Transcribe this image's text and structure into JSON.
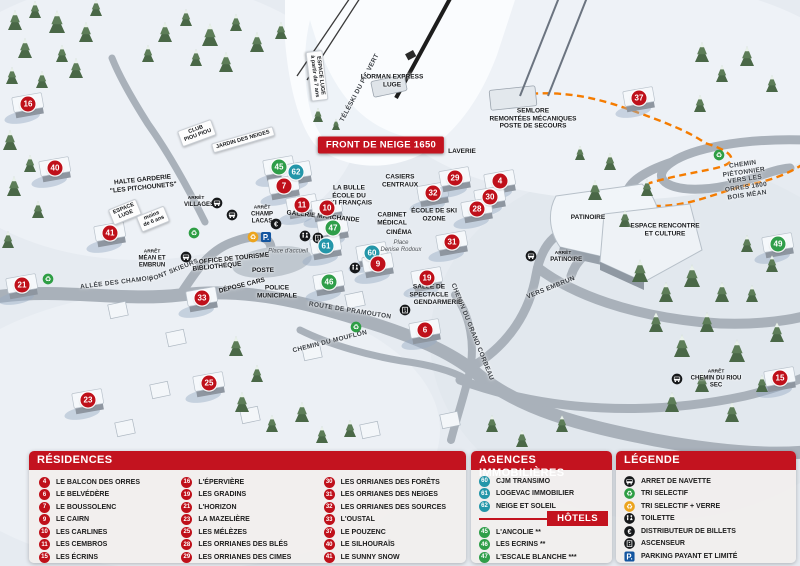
{
  "map": {
    "banner": {
      "text": "FRONT DE NEIGE 1650",
      "x": 381,
      "y": 145
    },
    "markers": [
      {
        "n": "16",
        "type": "r",
        "x": 28,
        "y": 104
      },
      {
        "n": "40",
        "type": "r",
        "x": 55,
        "y": 168
      },
      {
        "n": "41",
        "type": "r",
        "x": 110,
        "y": 233
      },
      {
        "n": "21",
        "type": "r",
        "x": 22,
        "y": 285
      },
      {
        "n": "33",
        "type": "r",
        "x": 202,
        "y": 298
      },
      {
        "n": "23",
        "type": "r",
        "x": 88,
        "y": 400
      },
      {
        "n": "25",
        "type": "r",
        "x": 209,
        "y": 383
      },
      {
        "n": "45",
        "type": "h",
        "x": 279,
        "y": 167
      },
      {
        "n": "62",
        "type": "a",
        "x": 296,
        "y": 172
      },
      {
        "n": "7",
        "type": "r",
        "x": 284,
        "y": 186
      },
      {
        "n": "11",
        "type": "r",
        "x": 302,
        "y": 205
      },
      {
        "n": "10",
        "type": "r",
        "x": 327,
        "y": 208
      },
      {
        "n": "47",
        "type": "h",
        "x": 333,
        "y": 228
      },
      {
        "n": "61",
        "type": "a",
        "x": 326,
        "y": 246
      },
      {
        "n": "46",
        "type": "h",
        "x": 329,
        "y": 282
      },
      {
        "n": "60",
        "type": "a",
        "x": 372,
        "y": 253
      },
      {
        "n": "9",
        "type": "r",
        "x": 378,
        "y": 264
      },
      {
        "n": "32",
        "type": "r",
        "x": 433,
        "y": 193
      },
      {
        "n": "29",
        "type": "r",
        "x": 455,
        "y": 178
      },
      {
        "n": "4",
        "type": "r",
        "x": 500,
        "y": 181
      },
      {
        "n": "30",
        "type": "r",
        "x": 490,
        "y": 197
      },
      {
        "n": "28",
        "type": "r",
        "x": 477,
        "y": 209
      },
      {
        "n": "31",
        "type": "r",
        "x": 452,
        "y": 242
      },
      {
        "n": "19",
        "type": "r",
        "x": 427,
        "y": 278
      },
      {
        "n": "6",
        "type": "r",
        "x": 425,
        "y": 330
      },
      {
        "n": "37",
        "type": "r",
        "x": 639,
        "y": 98
      },
      {
        "n": "49",
        "type": "h",
        "x": 778,
        "y": 244
      },
      {
        "n": "15",
        "type": "r",
        "x": 780,
        "y": 378
      }
    ],
    "labels": [
      {
        "text": "ESPACE LUGE\nà partir de 7 ans",
        "x": 317,
        "y": 76,
        "rot": 83,
        "style": "sign"
      },
      {
        "text": "TÉLÉSKI DU PIC VERT",
        "x": 360,
        "y": 88,
        "rot": -62,
        "style": "road"
      },
      {
        "text": "L'ORMAN EXPRESS\nLUGE",
        "x": 392,
        "y": 81,
        "rot": 0,
        "style": ""
      },
      {
        "text": "SEMLORE\nREMONTÉES MÉCANIQUES\nPOSTE DE SECOURS",
        "x": 533,
        "y": 119,
        "rot": 0,
        "style": ""
      },
      {
        "text": "CLUB\nPIOU PIOU",
        "x": 197,
        "y": 133,
        "rot": -20,
        "style": "sign"
      },
      {
        "text": "JARDIN DES NEIGES",
        "x": 243,
        "y": 140,
        "rot": -16,
        "style": "sign"
      },
      {
        "text": "HALTE GARDERIE\n\"LES PITCHOUNETS\"",
        "x": 143,
        "y": 184,
        "rot": -6,
        "style": ""
      },
      {
        "text": "ESPACE\nLUGE",
        "x": 125,
        "y": 212,
        "rot": -22,
        "style": "sign"
      },
      {
        "text": "moins\nde 6 ans",
        "x": 153,
        "y": 219,
        "rot": -22,
        "style": "sign"
      },
      {
        "text": "LA BULLE\nÉCOLE DU\nSKI FRANÇAIS",
        "x": 349,
        "y": 196,
        "rot": 0,
        "style": ""
      },
      {
        "text": "CASIERS\nCENTRAUX",
        "x": 400,
        "y": 181,
        "rot": 0,
        "style": ""
      },
      {
        "text": "LAVERIE",
        "x": 462,
        "y": 152,
        "rot": 0,
        "style": ""
      },
      {
        "text": "ÉCOLE DE SKI\nOZONE",
        "x": 434,
        "y": 215,
        "rot": 0,
        "style": ""
      },
      {
        "text": "GALERIE MARCHANDE",
        "x": 323,
        "y": 217,
        "rot": 6,
        "style": ""
      },
      {
        "text": "CABINET\nMÉDICAL",
        "x": 392,
        "y": 219,
        "rot": 0,
        "style": ""
      },
      {
        "text": "CINÉMA",
        "x": 399,
        "y": 233,
        "rot": 0,
        "style": ""
      },
      {
        "text": "Place\nDenise Rodoux",
        "x": 401,
        "y": 247,
        "rot": 0,
        "style": "place"
      },
      {
        "text": "Place d'accueil",
        "x": 288,
        "y": 252,
        "rot": 0,
        "style": "place"
      },
      {
        "text": "OFFICE DE TOURISME",
        "x": 234,
        "y": 259,
        "rot": -6,
        "style": ""
      },
      {
        "text": "BIBLIOTHÈQUE",
        "x": 217,
        "y": 267,
        "rot": -6,
        "style": ""
      },
      {
        "text": "POSTE",
        "x": 263,
        "y": 271,
        "rot": 0,
        "style": ""
      },
      {
        "text": "DÉPOSE CARS",
        "x": 242,
        "y": 286,
        "rot": -14,
        "style": ""
      },
      {
        "text": "POLICE\nMUNICIPALE",
        "x": 277,
        "y": 292,
        "rot": 0,
        "style": ""
      },
      {
        "text": "ALLÉE DES CHAMOIS",
        "x": 117,
        "y": 283,
        "rot": -7,
        "style": "road"
      },
      {
        "text": "PONT SKIEURS",
        "x": 174,
        "y": 271,
        "rot": -22,
        "style": "road"
      },
      {
        "text": "ROUTE DE PRAMOUTON",
        "x": 350,
        "y": 311,
        "rot": 9,
        "style": "road"
      },
      {
        "text": "CHEMIN DU MOUFLON",
        "x": 330,
        "y": 342,
        "rot": -14,
        "style": "road"
      },
      {
        "text": "CHEMIN DU GRAND CORBEAU",
        "x": 472,
        "y": 332,
        "rot": 68,
        "style": "road"
      },
      {
        "text": "SALLE DE\nSPECTACLE",
        "x": 429,
        "y": 291,
        "rot": 0,
        "style": ""
      },
      {
        "text": "GENDARMERIE",
        "x": 438,
        "y": 303,
        "rot": 0,
        "style": ""
      },
      {
        "text": "PATINOIRE",
        "x": 588,
        "y": 218,
        "rot": 0,
        "style": ""
      },
      {
        "text": "VERS EMBRUN",
        "x": 551,
        "y": 288,
        "rot": -22,
        "style": "road"
      },
      {
        "text": "ESPACE RENCONTRE\nET CULTURE",
        "x": 665,
        "y": 230,
        "rot": 0,
        "style": ""
      },
      {
        "text": "CHEMIN PIÉTONNIER\nVERS LES ORRES 1800\nBOIS MÉAN",
        "x": 745,
        "y": 180,
        "rot": -8,
        "style": "road"
      },
      {
        "text": "ARRÊT\nVILLAGES",
        "x": 196,
        "y": 202,
        "rot": 0,
        "style": "stop"
      },
      {
        "text": "ARRÊT\nCHAMP LACAS",
        "x": 262,
        "y": 215,
        "rot": 0,
        "style": "stop"
      },
      {
        "text": "ARRÊT\nMÉAN ET EMBRUN",
        "x": 152,
        "y": 259,
        "rot": 0,
        "style": "stop"
      },
      {
        "text": "ARRÊT\nPATINOIRE",
        "x": 563,
        "y": 257,
        "rot": 0,
        "style": "stop"
      },
      {
        "text": "ARRÊT\nCHEMIN DU RIOU SEC",
        "x": 716,
        "y": 379,
        "rot": 0,
        "style": "stop"
      }
    ],
    "icons": [
      {
        "type": "bus",
        "x": 217,
        "y": 203
      },
      {
        "type": "bus",
        "x": 232,
        "y": 215
      },
      {
        "type": "bus",
        "x": 186,
        "y": 257
      },
      {
        "type": "bus",
        "x": 531,
        "y": 256
      },
      {
        "type": "bus",
        "x": 677,
        "y": 379
      },
      {
        "type": "recycle-green",
        "x": 194,
        "y": 233
      },
      {
        "type": "recycle-green",
        "x": 48,
        "y": 279
      },
      {
        "type": "recycle-green",
        "x": 356,
        "y": 327
      },
      {
        "type": "recycle-green",
        "x": 719,
        "y": 155
      },
      {
        "type": "recycle-yellow",
        "x": 253,
        "y": 237
      },
      {
        "type": "parking",
        "x": 266,
        "y": 237
      },
      {
        "type": "euro",
        "x": 276,
        "y": 224
      },
      {
        "type": "wc",
        "x": 305,
        "y": 236
      },
      {
        "type": "elevator",
        "x": 318,
        "y": 238
      },
      {
        "type": "wc",
        "x": 355,
        "y": 268
      },
      {
        "type": "elevator",
        "x": 405,
        "y": 310
      }
    ]
  },
  "legend": {
    "residences": {
      "title": "RÉSIDENCES",
      "items": [
        {
          "n": "4",
          "label": "LE BALCON DES ORRES"
        },
        {
          "n": "6",
          "label": "LE BELVÉDÈRE"
        },
        {
          "n": "7",
          "label": "LE BOUSSOLENC"
        },
        {
          "n": "9",
          "label": "LE CAIRN"
        },
        {
          "n": "10",
          "label": "LES CARLINES"
        },
        {
          "n": "11",
          "label": "LES CEMBROS"
        },
        {
          "n": "15",
          "label": "LES ÉCRINS"
        },
        {
          "n": "16",
          "label": "L'ÉPERVIÈRE"
        },
        {
          "n": "19",
          "label": "LES GRADINS"
        },
        {
          "n": "21",
          "label": "L'HORIZON"
        },
        {
          "n": "23",
          "label": "LA MAZELIÈRE"
        },
        {
          "n": "25",
          "label": "LES MÉLÈZES"
        },
        {
          "n": "28",
          "label": "LES ORRIANES DES BLÉS"
        },
        {
          "n": "29",
          "label": "LES ORRIANES DES CIMES"
        },
        {
          "n": "30",
          "label": "LES ORRIANES DES FORÊTS"
        },
        {
          "n": "31",
          "label": "LES ORRIANES DES NEIGES"
        },
        {
          "n": "32",
          "label": "LES ORRIANES DES SOURCES"
        },
        {
          "n": "33",
          "label": "L'OUSTAL"
        },
        {
          "n": "37",
          "label": "LE POUZENC"
        },
        {
          "n": "40",
          "label": "LE SILHOURAÏS"
        },
        {
          "n": "41",
          "label": "LE SUNNY SNOW"
        }
      ]
    },
    "agences": {
      "title": "AGENCES IMMOBILIÈRES",
      "items": [
        {
          "n": "60",
          "label": "CJM TRANSIMO"
        },
        {
          "n": "61",
          "label": "LOGEVAC IMMOBILIER"
        },
        {
          "n": "62",
          "label": "NEIGE ET SOLEIL"
        }
      ]
    },
    "hotels": {
      "title": "HÔTELS",
      "items": [
        {
          "n": "45",
          "label": "L'ANCOLIE **"
        },
        {
          "n": "46",
          "label": "LES ECRINS **"
        },
        {
          "n": "47",
          "label": "L'ESCALE BLANCHE ***"
        },
        {
          "n": "49",
          "label": "LES TRAPPEURS **"
        }
      ]
    },
    "legende": {
      "title": "LÉGENDE",
      "items": [
        {
          "icon": "bus",
          "label": "ARRET DE NAVETTE"
        },
        {
          "icon": "recycle-green",
          "label": "TRI SELECTIF"
        },
        {
          "icon": "recycle-yellow",
          "label": "TRI SELECTIF + VERRE"
        },
        {
          "icon": "wc",
          "label": "TOILETTE"
        },
        {
          "icon": "euro",
          "label": "DISTRIBUTEUR DE BILLETS"
        },
        {
          "icon": "elevator",
          "label": "ASCENSEUR"
        },
        {
          "icon": "parking",
          "label": "PARKING PAYANT ET LIMITÉ"
        }
      ]
    }
  },
  "colors": {
    "residence": "#bf101a",
    "agence": "#2496a9",
    "hotel": "#2f9e49",
    "header_red": "#c3131f",
    "panel_bg": "#f1eeed",
    "path_orange": "#f57c00"
  }
}
